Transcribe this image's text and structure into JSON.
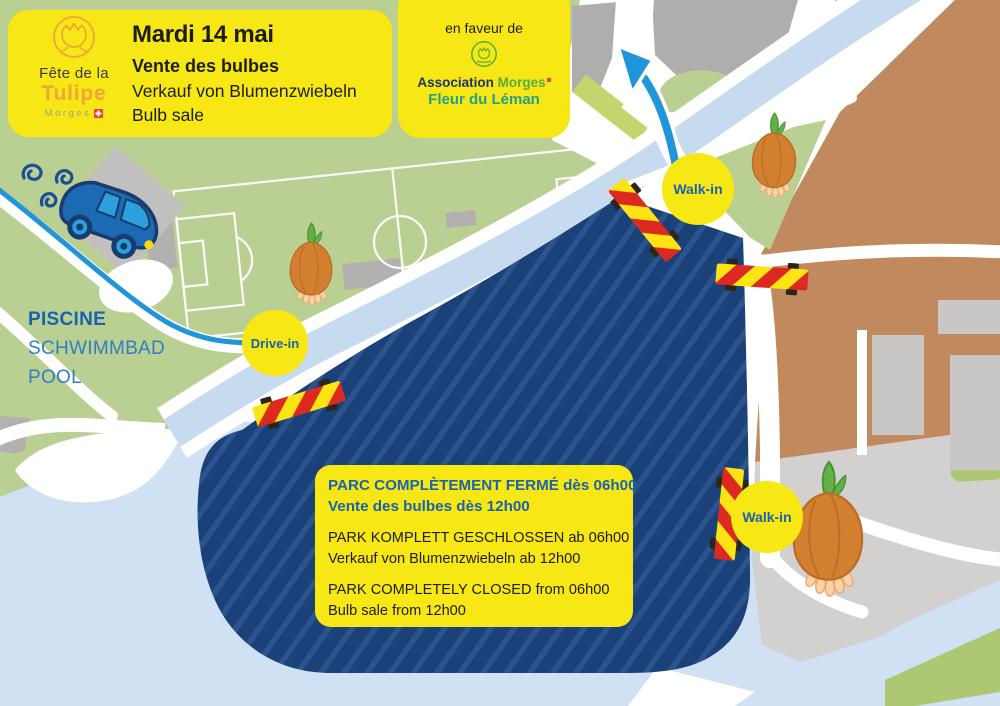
{
  "poster": {
    "banner": {
      "title": "Mardi 14 mai",
      "line_fr": "Vente des bulbes",
      "line_de": "Verkauf von Blumenzwiebeln",
      "line_en": "Bulb sale"
    },
    "logo": {
      "top": "Fête de la",
      "name": "Tulipe",
      "city": "Morges"
    },
    "sponsor": {
      "intro": "en faveur de",
      "org_a": "Association",
      "org_b": "Morges",
      "org_line2": "Fleur du Léman"
    },
    "pool": {
      "fr": "PISCINE",
      "de": "SCHWIMMBAD",
      "en": "POOL"
    },
    "markers": {
      "drive_in": "Drive-in",
      "walk_in_north": "Walk-in",
      "walk_in_east": "Walk-in"
    },
    "notice": {
      "fr1": "PARC COMPLÈTEMENT FERMÉ dès 06h00",
      "fr2": "Vente des bulbes dès 12h00",
      "de1": "PARK KOMPLETT GESCHLOSSEN ab 06h00",
      "de2": "Verkauf von Blumenzwiebeln ab 12h00",
      "en1": "PARK COMPLETELY CLOSED from 06h00",
      "en2": "Bulb sale from 12h00"
    },
    "colors": {
      "yellow": "#f7e714",
      "navy_text": "#1a63ae",
      "pool_blue": "#2e7fc3",
      "park_navy": "#1b4179",
      "map_green": "#bacf92",
      "water": "#cfe1f2",
      "route_blue": "#2095d8",
      "tan": "#c0895e",
      "barrier_red": "#dd2a20",
      "barrier_yellow": "#ffe414",
      "bulb_orange": "#d2802f",
      "logo_orange": "#efa43c",
      "sponsor_green": "#57ae3f",
      "sponsor_teal": "#23a088"
    }
  }
}
